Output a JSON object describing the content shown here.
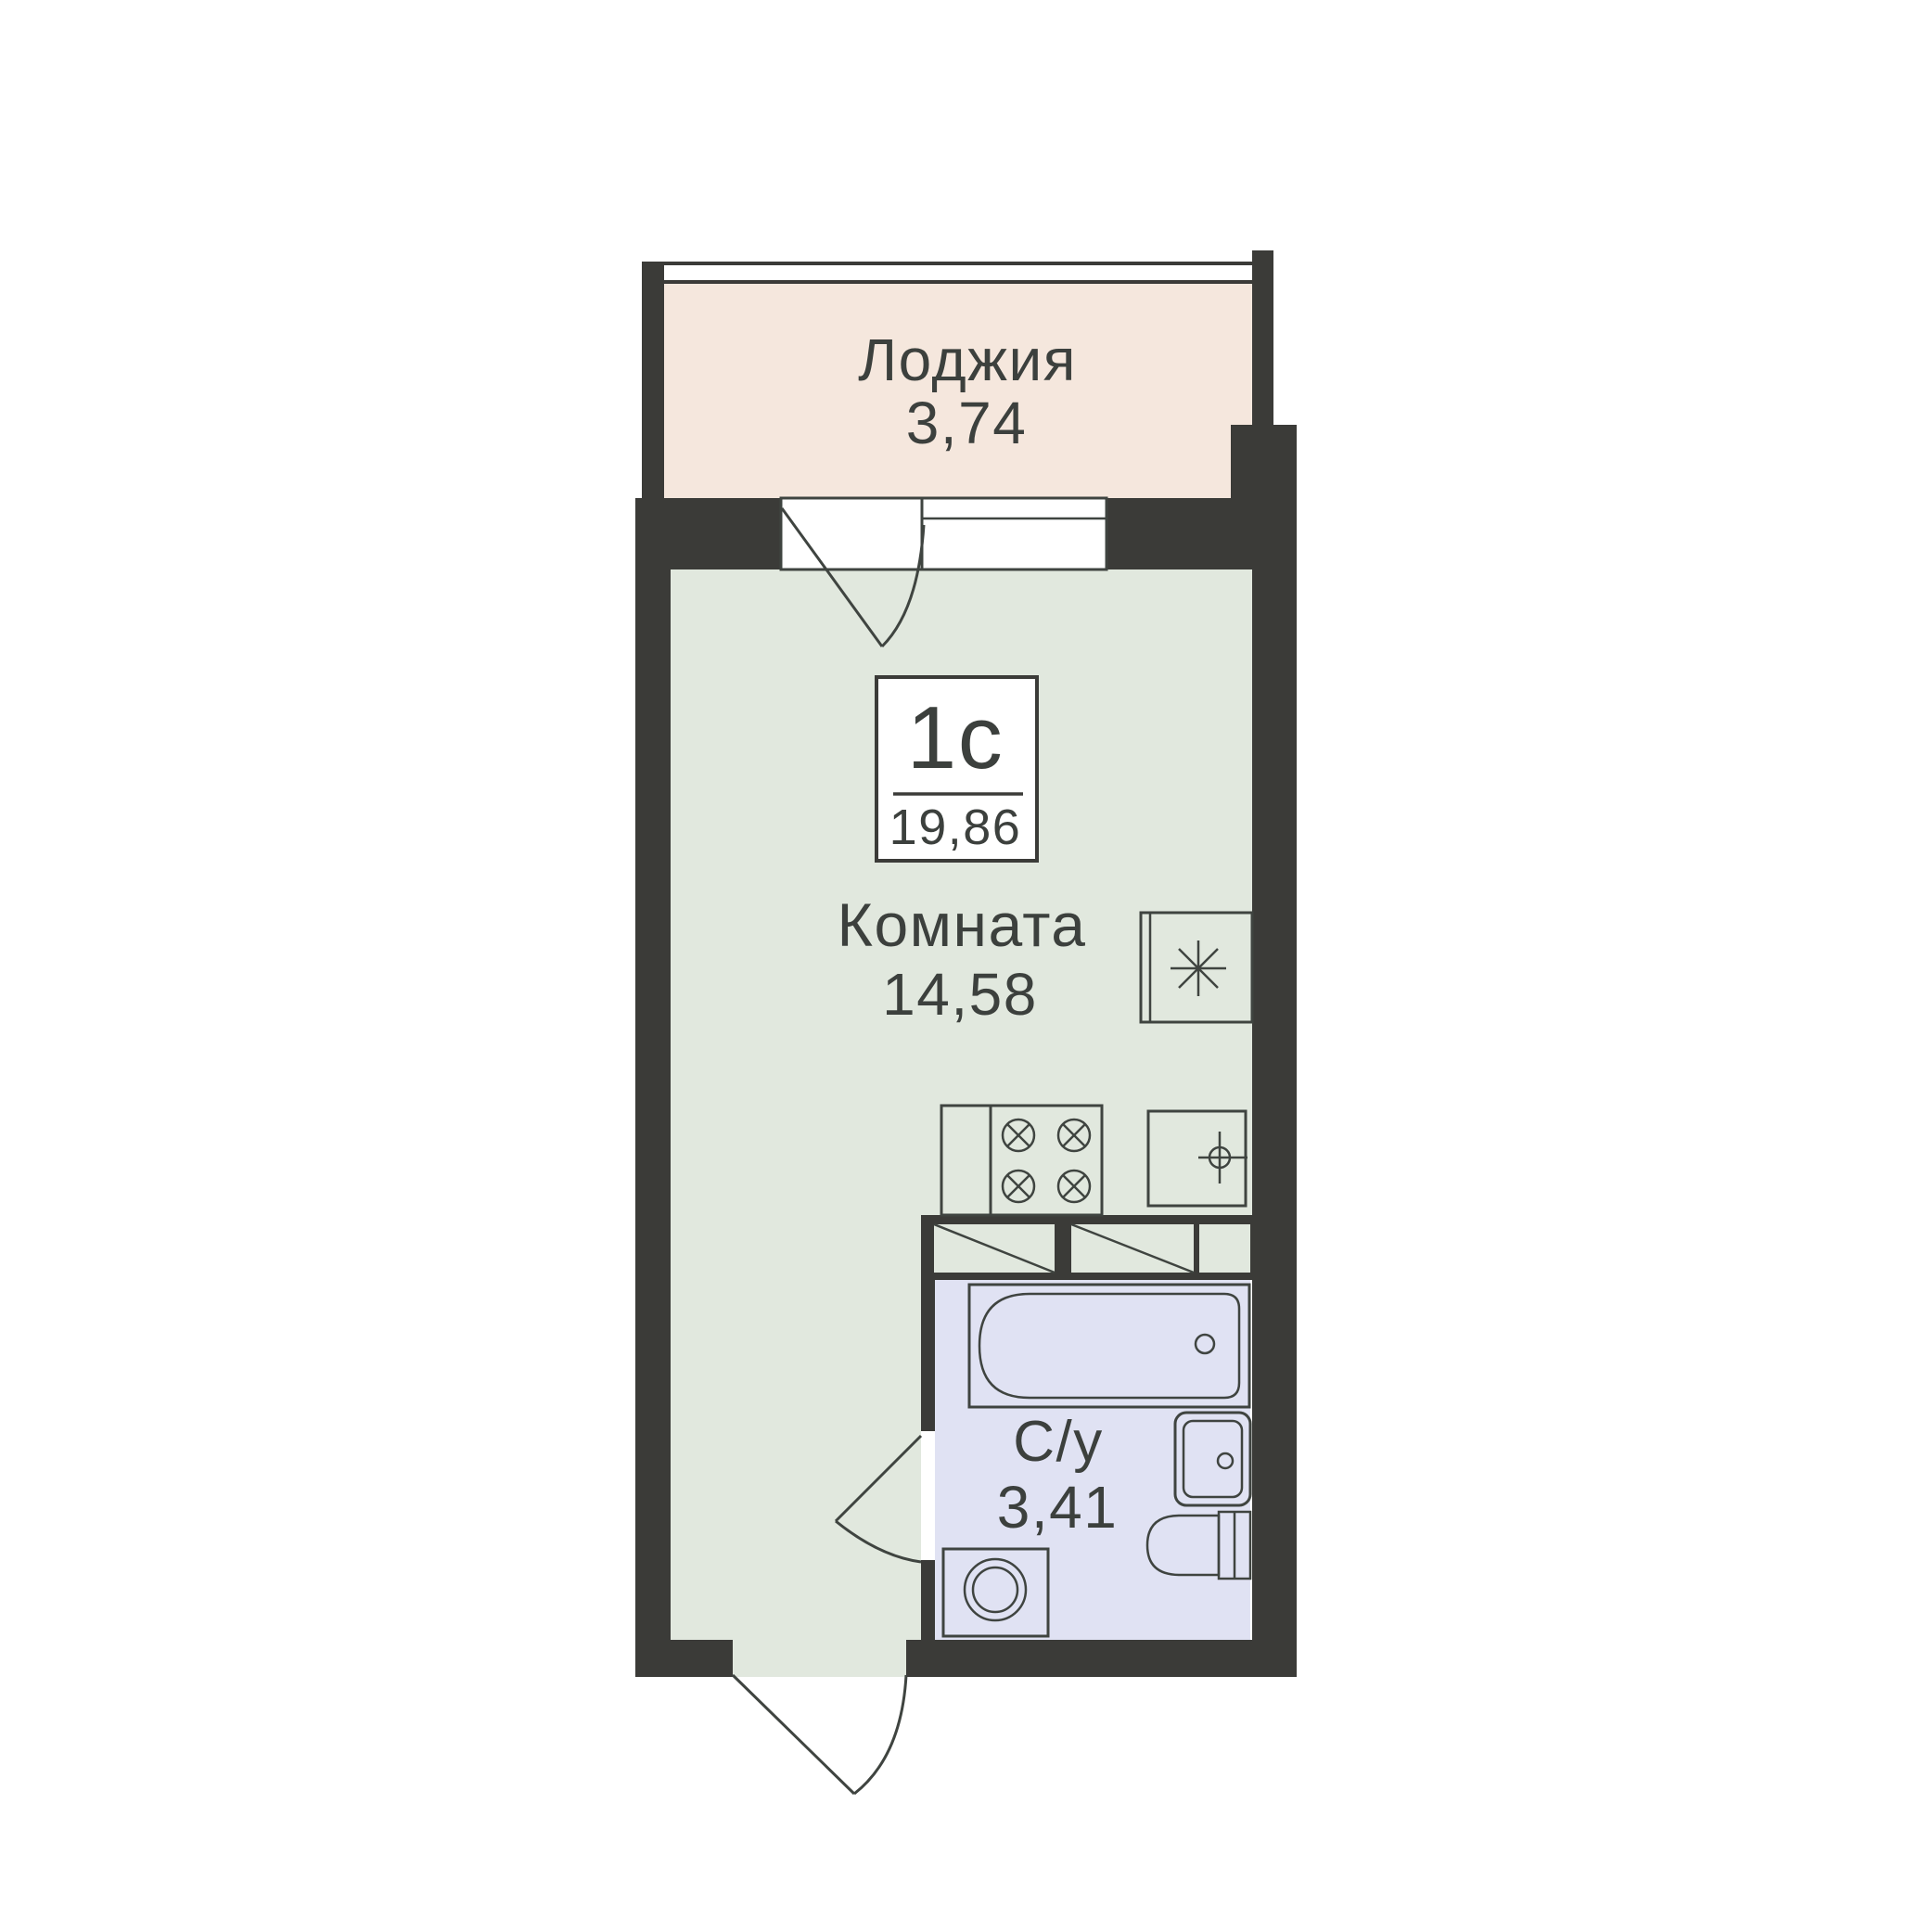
{
  "colors": {
    "wall": "#3b3b38",
    "loggia_fill": "#f5e7dd",
    "room_fill": "#e1e8de",
    "bath_fill": "#e0e2f3",
    "line": "#3f4440",
    "text": "#3c403d",
    "bg": "#ffffff"
  },
  "labels": {
    "loggia": {
      "name": "Лоджия",
      "area": "3,74"
    },
    "unit": {
      "type": "1с",
      "total_area": "19,86"
    },
    "room": {
      "name": "Комната",
      "area": "14,58"
    },
    "bathroom": {
      "name": "С/у",
      "area": "3,41"
    }
  },
  "icons": {
    "fridge": "asterisk-star",
    "stove": "four-crossed-burners",
    "kitchen_sink": "crosshair-faucet",
    "washing_machine": "double-circle-drum",
    "bathtub": "rounded-tub-with-drain",
    "washbasin": "rounded-basin-with-drain",
    "toilet": "bowl-with-tank",
    "doors": "quarter-arc-swing",
    "window": "double-line-glazing"
  }
}
